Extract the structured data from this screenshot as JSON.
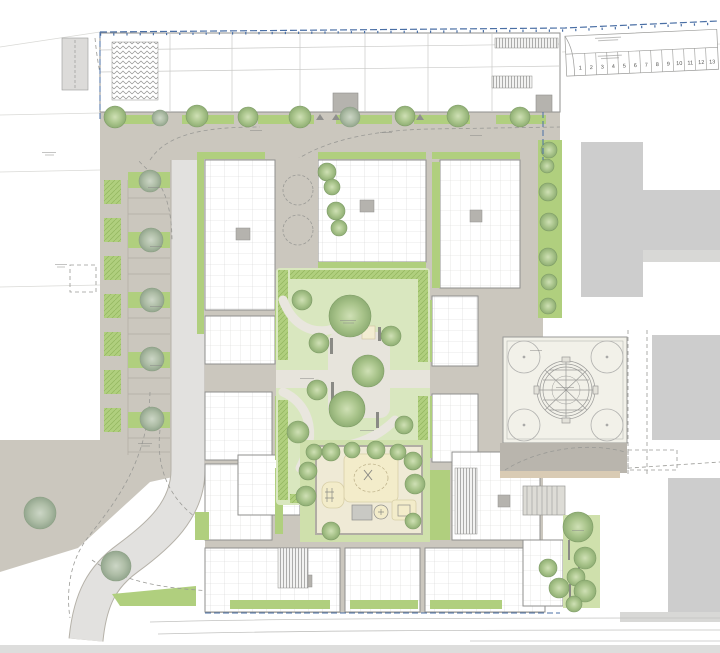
{
  "plan": {
    "parking_row": {
      "stall_labels": [
        "1",
        "2",
        "3",
        "4",
        "5",
        "6",
        "7",
        "8",
        "9",
        "10",
        "11",
        "12",
        "13"
      ]
    },
    "palette": {
      "street": "#cbc7be",
      "street_dark": "#b9b5ad",
      "roadway": "#e2e1df",
      "lawn": "#d9e7bf",
      "lawn_light": "#cfe0ac",
      "bed": "#b0cf7e",
      "playground": "#f3ecca",
      "playground_court": "#efead6",
      "plaza": "#f2f1e9",
      "building_fill": "#ffffff",
      "building_line": "#8f8f8d",
      "context_gray": "#cdcdcd",
      "context_gray_light": "#d8d8d6",
      "boundary_blue": "#4a6fa5",
      "sand_strip": "#d9cbb4",
      "tree_core": "#cfe0b5",
      "tree_edge": "#8fae74"
    }
  }
}
